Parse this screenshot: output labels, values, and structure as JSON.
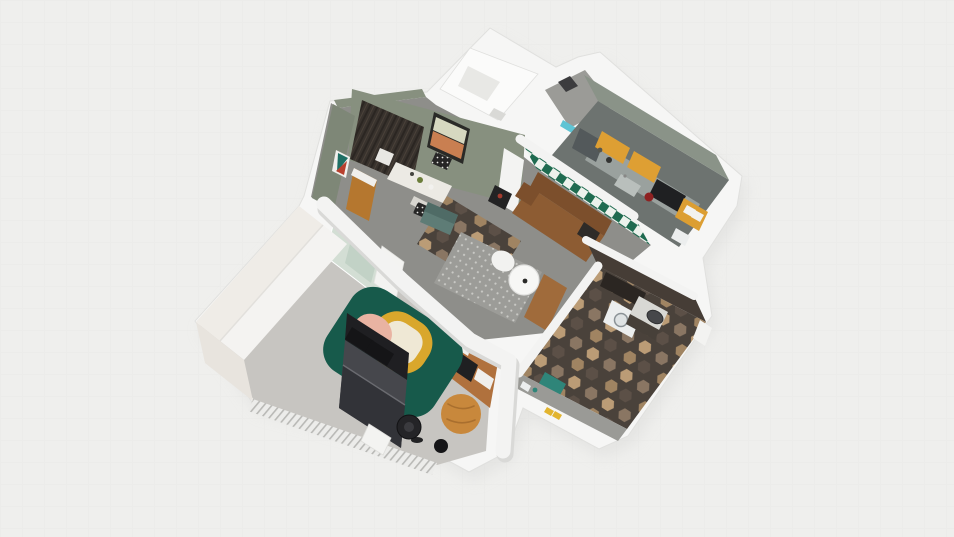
{
  "view": {
    "name": "floorplan-3d-orbit-view",
    "background": "light-gray-grid"
  },
  "palette": {
    "bg": "#efefed",
    "grid": "#ececea",
    "shadow": "#dcdcda",
    "wallWhite": "#f6f6f5",
    "wallEdge": "#e0e0de",
    "capWhite": "#f3f3f2",
    "balconyFloor": "#fbfbfa",
    "balconyPanel": "#e8e8e5",
    "balconyItem": "#d9d9d6",
    "hallFloor": "#9b9b97",
    "doorCyan": "#5fc4d4",
    "doorDark": "#3c3c3e",
    "kitchenFloor": "#6d7370",
    "kitchenWall": "#8a9388",
    "counterGray": "#9aa19e",
    "cabinetYellow": "#de9f33",
    "applianceDark": "#1f2022",
    "fridgeGray": "#53595b",
    "shelfYellow": "#dc9e32",
    "shelfCell": "#f2f2ef",
    "kettleRed": "#8e2121",
    "sinkSteel": "#b9bfbc",
    "checkerGreen": "#1f6b50",
    "checkerWhite": "#ecf2ec",
    "livingFloor": "#8e8e8a",
    "sageFace": "#87907f",
    "sageFaceDark": "#7e8777",
    "woodPanelDark": "#38322d",
    "woodPanelDarker": "#2b2622",
    "woodStreak": "#4a4139",
    "artFrame": "#2a2a27",
    "artBandTop": "#d6d8c0",
    "artBandBottom": "#c97f51",
    "artTeal": "#1e6f64",
    "artRed": "#b8402e",
    "artWhite": "#f0efec",
    "sideboardWood": "#b5772f",
    "tableWhite": "#eceae4",
    "tableLeg": "#d8d6d0",
    "chairDark": "#262626",
    "chairDotWhite": "#e8e7e3",
    "tealSofa": "#5e7c76",
    "tealSofaDark": "#4f6b66",
    "sofaBrown": "#8d5c33",
    "sofaBrownDark": "#7c4f2c",
    "pillowDark": "#2e2b28",
    "stoolBlack": "#232324",
    "rugGray": "#9c9c98",
    "rugDot": "#c9c9c5",
    "poufWhite": "#f2f2f0",
    "tableRound": "#f7f7f5",
    "woodFloorStrip": "#a06b3b",
    "hexDark": "#4a423b",
    "hexTan": "#bb9c76",
    "hexTan2": "#a08462",
    "hexTaupe": "#8a7663",
    "hexBrown": "#5c5047",
    "bathWall": "#463d36",
    "bathWallDark": "#2b2622",
    "washerWhite": "#eceeee",
    "washerDoor": "#dfe3e4",
    "washerRing": "#8b9296",
    "counterBathDark": "#474039",
    "counterBathTop": "#d8d8d4",
    "sinkDark": "#46474a",
    "matTeal": "#2f8579",
    "slipperYellow": "#e2b42e",
    "grayBand": "#9a9a96",
    "bedroomFloor": "#c7c5c1",
    "terracotta": "#b0713d",
    "glassDoor": "#d3ded4",
    "glassTint": "#c2d2c6",
    "doorWhite": "#f3f3f1",
    "rugGreen": "#175a4b",
    "rugYellow": "#d9a72c",
    "rugCream": "#efe8d5",
    "rugPink": "#e9b3a2",
    "bedHeadboard": "#1f1f22",
    "bedBody": "#46474c",
    "bedBlanket": "#323338",
    "bedPillow": "#151517",
    "bedSeam": "#6a6b70",
    "poufOrange": "#c8883c",
    "poufCrease": "#a96f2e",
    "fanBlack": "#242427",
    "fanInner": "#3a3a3e",
    "wardrobeTop": "#f4f3f1",
    "wardrobeFront": "#e8e4de",
    "wardrobeBeige": "#efece7",
    "wardrobeSeam": "#e2e0dc",
    "hatchBase": "#ececea",
    "hatchLine": "#b9b9b6"
  },
  "scene": {
    "rooms": [
      {
        "name": "balcony",
        "items": [
          "glass-panel",
          "storage-box"
        ]
      },
      {
        "name": "entry-hall",
        "items": [
          "cyan-door",
          "dark-door"
        ]
      },
      {
        "name": "kitchen",
        "items": [
          "fridge",
          "counter",
          "upper-cabinet-left",
          "upper-cabinet-right",
          "stove",
          "sink",
          "kettle",
          "yellow-shelf-unit",
          "small-appliance"
        ]
      },
      {
        "name": "living-dining-room",
        "items": [
          "wood-wardrobe-panel",
          "banded-wall-art",
          "small-wall-art",
          "sideboard",
          "dining-table",
          "dining-chairs",
          "teal-armchair",
          "leather-sofa",
          "black-side-table",
          "gray-rug",
          "white-pouf",
          "round-coffee-table",
          "checkerboard-wall",
          "hex-tile-entry"
        ]
      },
      {
        "name": "bathroom",
        "items": [
          "washing-machine",
          "vanity-counter",
          "oval-sink",
          "wall-cabinet",
          "teal-mat",
          "yellow-slippers",
          "hex-tile-floor",
          "white-door"
        ]
      },
      {
        "name": "bedroom",
        "items": [
          "white-wardrobe",
          "sliding-glass-doors",
          "open-door",
          "gallery-wall",
          "layered-rug",
          "double-bed",
          "orange-pouf",
          "floor-fan",
          "black-speaker",
          "white-door",
          "hatched-glass-wall"
        ]
      }
    ]
  }
}
